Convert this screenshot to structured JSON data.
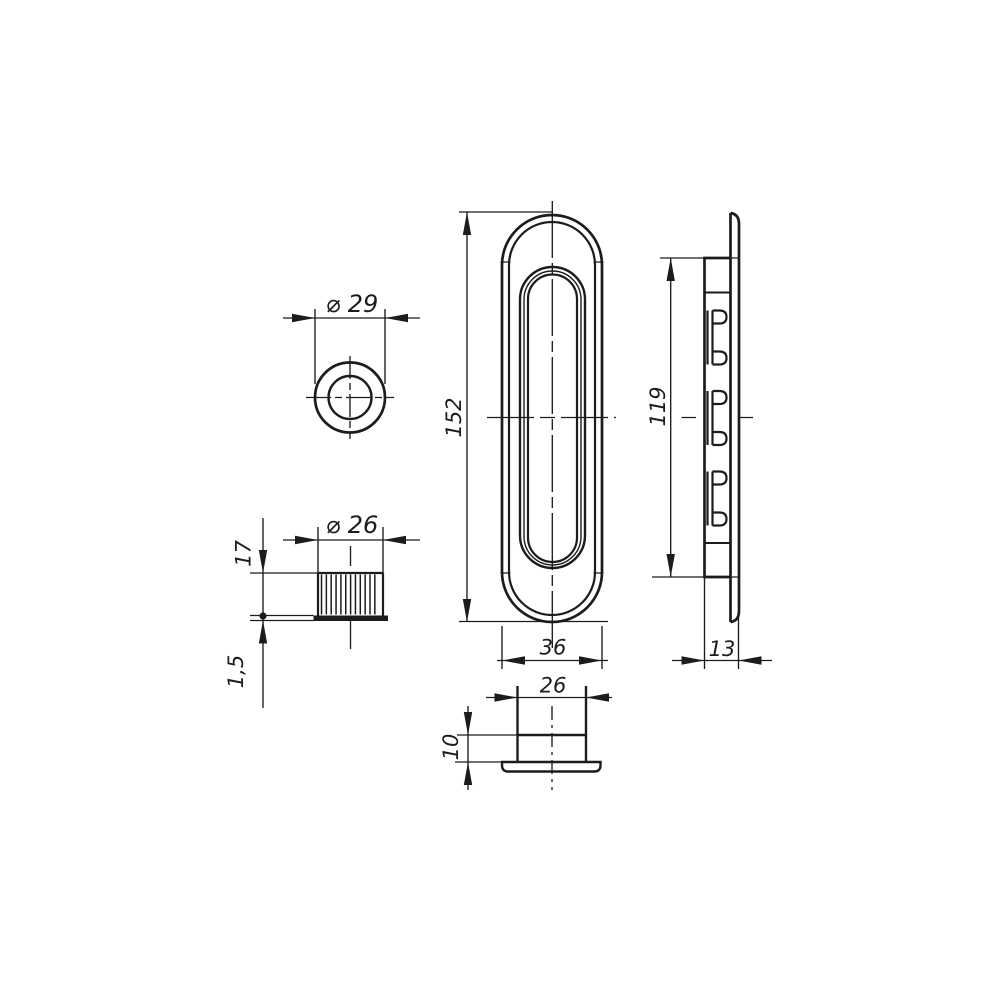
{
  "drawing": {
    "background": "#ffffff",
    "line_color": "#1c1c1c",
    "dimensions": {
      "knob_flange_diameter": "⌀ 29",
      "knob_body_diameter": "⌀ 26",
      "knob_height": "17",
      "knob_flange_thickness": "1,5",
      "handle_length": "152",
      "handle_width": "36",
      "cup_length": "119",
      "handle_depth": "13",
      "cup_diameter": "26",
      "cup_depth": "10"
    }
  }
}
